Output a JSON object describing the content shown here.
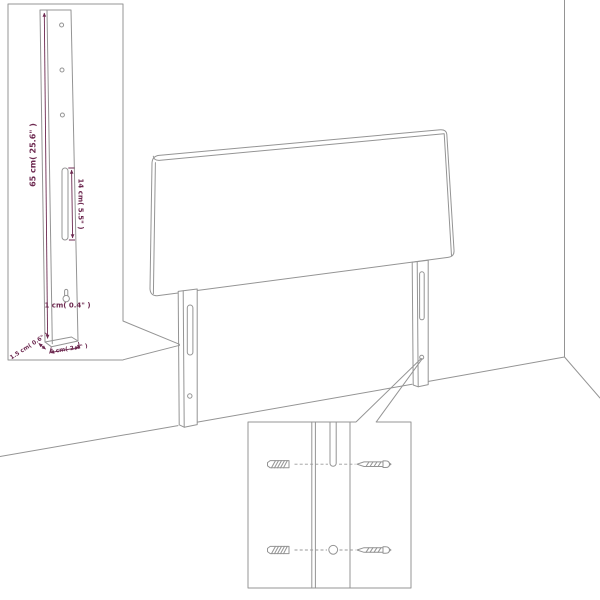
{
  "figure": {
    "subject": "headboard assembly dimension diagram",
    "background_color": "#ffffff",
    "line_color": "#949494",
    "dimension_color": "#6d2950"
  },
  "dimensions": {
    "leg_height": "65 cm( 25.6\" )",
    "slot_length": "14 cm( 5.5\" )",
    "hole_diameter": "1 cm( 0.4\" )",
    "leg_depth": "1.5 cm( 0.6\" )",
    "leg_width": "6 cm( 2.4\" )"
  },
  "insets": {
    "leg_detail": {
      "holes_count": 3,
      "has_slot": true,
      "has_keyhole": true
    },
    "mounting_detail": {
      "hardware": [
        "wall-anchor",
        "screw",
        "wall-anchor",
        "screw"
      ]
    }
  }
}
